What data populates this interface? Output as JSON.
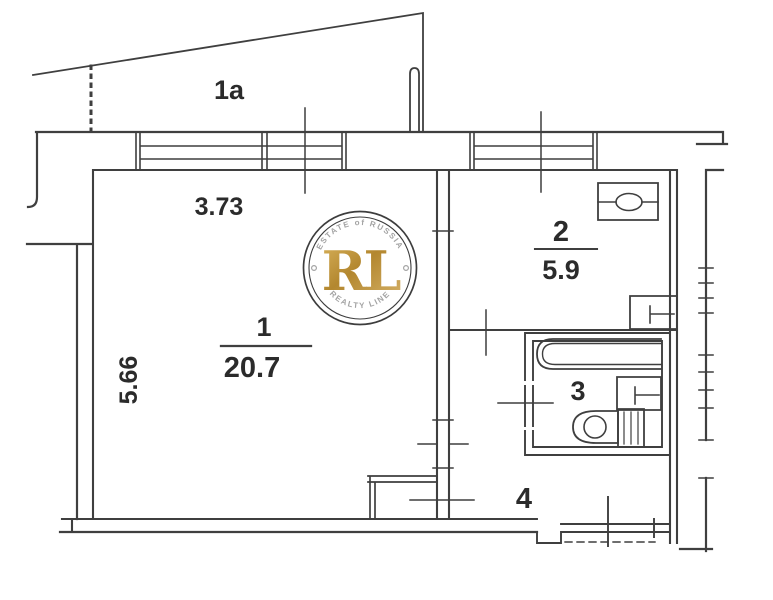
{
  "diagram": {
    "type": "apartment floor plan",
    "colors": {
      "line": "#3f3f3f",
      "text": "#2b2b2b",
      "background": "#ffffff",
      "watermark_gold": "#c09a3e",
      "watermark_ring": "#3d3d3d",
      "watermark_arc_text": "#a3a3a3"
    },
    "rooms": [
      {
        "label": "1a"
      },
      {
        "label": "1",
        "area": "20.7",
        "width_dim": "3.73",
        "height_dim": "5.66"
      },
      {
        "label": "2",
        "area": "5.9"
      },
      {
        "label": "3"
      },
      {
        "label": "4"
      }
    ],
    "fixtures": [
      "bathtub",
      "toilet",
      "sink",
      "stove",
      "kitchen-unit",
      "radiator-ticks"
    ],
    "watermark": {
      "top_text": "ESTATE of RUSSIA",
      "monogram": "RL",
      "bottom_text": "REALTY LINE"
    }
  }
}
